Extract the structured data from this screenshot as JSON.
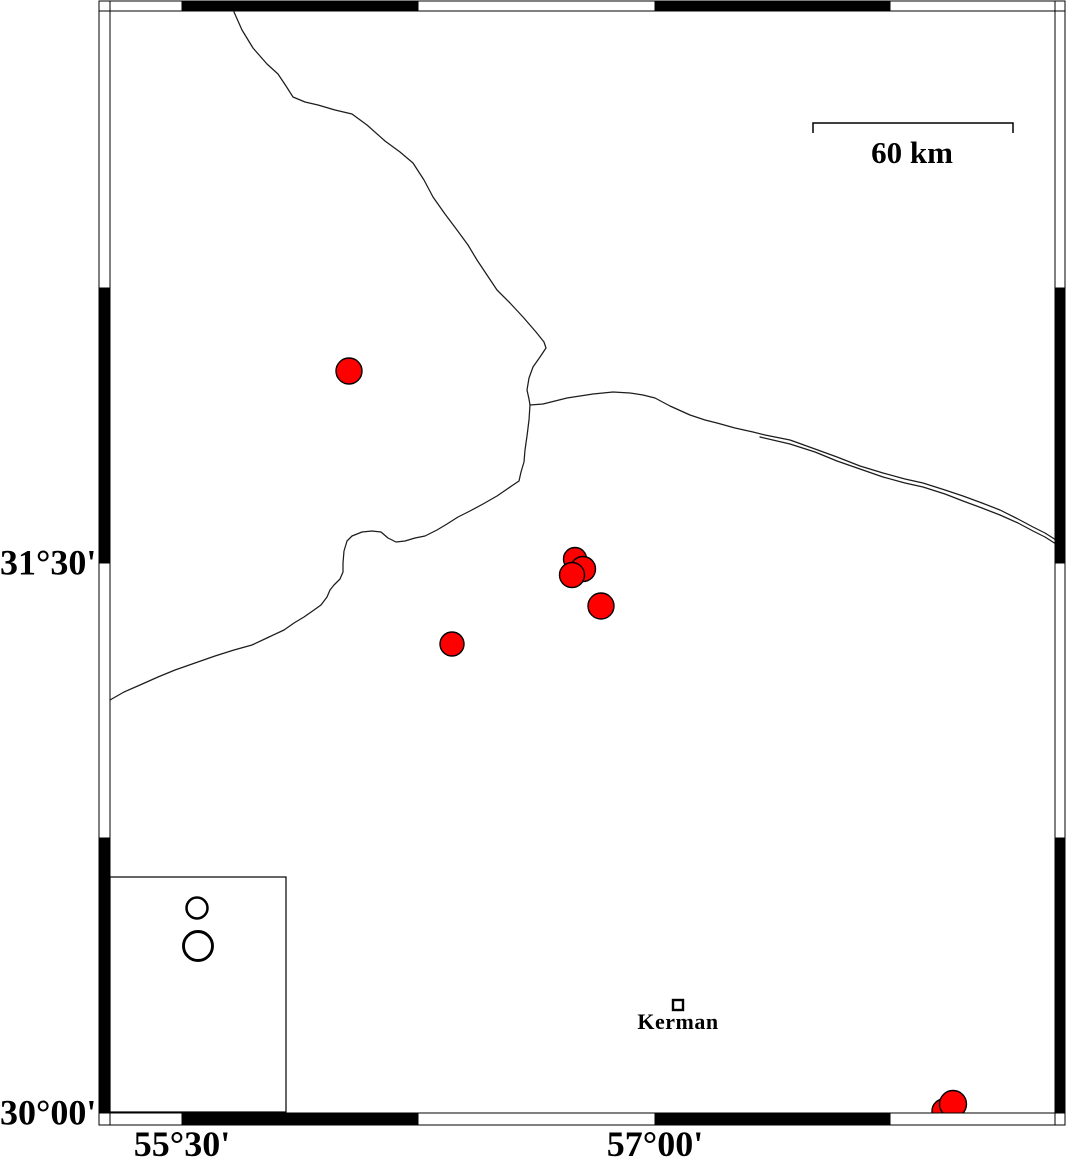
{
  "frame": {
    "outer": {
      "x": 99,
      "y": 1,
      "w": 966,
      "h": 1124
    },
    "inner": {
      "x": 110,
      "y": 11,
      "w": 945,
      "h": 1102
    },
    "x_bounds": [
      110,
      182,
      418,
      655,
      890,
      1055
    ],
    "x_fills": [
      "#ffffff",
      "#000000",
      "#ffffff",
      "#000000",
      "#ffffff"
    ],
    "y_bounds": [
      11,
      288,
      563,
      838,
      1113
    ],
    "y_fills": [
      "#ffffff",
      "#000000",
      "#ffffff",
      "#000000"
    ],
    "line_color": "#000000"
  },
  "axes": {
    "lat_labels": [
      {
        "text": "31°30'",
        "y": 563
      },
      {
        "text": "30°00'",
        "y": 1113
      }
    ],
    "lon_labels": [
      {
        "text": "55°30'",
        "x": 182
      },
      {
        "text": "57°00'",
        "x": 655
      }
    ]
  },
  "scale_bar": {
    "label": "60 km",
    "x1": 813,
    "x2": 1013,
    "y": 123,
    "tick_len": 10,
    "label_pos": {
      "x": 912,
      "y": 137
    }
  },
  "city": {
    "label": "Kerman",
    "x": 678,
    "y": 1005,
    "size": 10,
    "label_pos": {
      "x": 678,
      "y": 1011
    }
  },
  "legend": {
    "box": {
      "x": 110,
      "y": 877,
      "w": 176,
      "h": 235
    },
    "symbols": [
      {
        "x": 197,
        "y": 908,
        "r": 10.5,
        "stroke_w": 2.5
      },
      {
        "x": 198,
        "y": 946,
        "r": 14.5,
        "stroke_w": 2.9
      }
    ]
  },
  "epicenters": {
    "fill": "#ff0000",
    "stroke": "#000000",
    "stroke_w": 1.4,
    "points": [
      {
        "x": 349,
        "y": 371,
        "r": 13
      },
      {
        "x": 944,
        "y": 1111,
        "r": 12
      },
      {
        "x": 953,
        "y": 1104,
        "r": 13.5
      },
      {
        "x": 575,
        "y": 559,
        "r": 11.5
      },
      {
        "x": 583,
        "y": 569,
        "r": 12.5
      },
      {
        "x": 572,
        "y": 575,
        "r": 12.5
      },
      {
        "x": 601,
        "y": 606,
        "r": 13
      },
      {
        "x": 452,
        "y": 644,
        "r": 12
      }
    ]
  },
  "boundaries": {
    "stroke": "#1c1c1c",
    "width": 1.25,
    "paths": [
      [
        [
          234,
          12
        ],
        [
          242,
          30
        ],
        [
          253,
          48
        ],
        [
          267,
          64
        ],
        [
          278,
          74
        ],
        [
          286,
          86
        ],
        [
          293,
          97
        ],
        [
          305,
          102
        ],
        [
          318,
          105
        ],
        [
          335,
          110
        ],
        [
          352,
          114
        ],
        [
          367,
          125
        ],
        [
          385,
          141
        ],
        [
          400,
          152
        ],
        [
          413,
          163
        ],
        [
          424,
          180
        ],
        [
          433,
          197
        ],
        [
          445,
          214
        ],
        [
          457,
          230
        ],
        [
          468,
          245
        ],
        [
          477,
          260
        ],
        [
          487,
          275
        ],
        [
          497,
          290
        ],
        [
          510,
          303
        ],
        [
          523,
          317
        ],
        [
          536,
          332
        ],
        [
          544,
          342
        ],
        [
          546,
          348
        ],
        [
          540,
          357
        ],
        [
          533,
          367
        ],
        [
          529,
          378
        ],
        [
          527,
          390
        ],
        [
          529,
          399
        ],
        [
          530,
          405
        ]
      ],
      [
        [
          530,
          405
        ],
        [
          543,
          404
        ],
        [
          567,
          398
        ],
        [
          593,
          394
        ],
        [
          613,
          392
        ],
        [
          630,
          393
        ],
        [
          643,
          395
        ],
        [
          655,
          398
        ],
        [
          670,
          406
        ],
        [
          690,
          415
        ],
        [
          705,
          420
        ],
        [
          717,
          423
        ],
        [
          735,
          428
        ],
        [
          753,
          432
        ],
        [
          765,
          435
        ],
        [
          790,
          440
        ],
        [
          815,
          449
        ],
        [
          837,
          457
        ],
        [
          860,
          466
        ],
        [
          883,
          473
        ],
        [
          905,
          479
        ],
        [
          923,
          483
        ],
        [
          945,
          490
        ],
        [
          963,
          496
        ],
        [
          982,
          503
        ],
        [
          1000,
          510
        ],
        [
          1018,
          519
        ],
        [
          1033,
          527
        ],
        [
          1045,
          533
        ],
        [
          1056,
          540
        ]
      ],
      [
        [
          760,
          437
        ],
        [
          790,
          444
        ],
        [
          815,
          452
        ],
        [
          837,
          461
        ],
        [
          860,
          469
        ],
        [
          883,
          477
        ],
        [
          905,
          483
        ],
        [
          923,
          487
        ],
        [
          945,
          494
        ],
        [
          963,
          501
        ],
        [
          982,
          508
        ],
        [
          1000,
          515
        ],
        [
          1018,
          523
        ],
        [
          1033,
          531
        ],
        [
          1045,
          537
        ],
        [
          1056,
          544
        ]
      ],
      [
        [
          530,
          405
        ],
        [
          529,
          420
        ],
        [
          527,
          436
        ],
        [
          525,
          450
        ],
        [
          524,
          462
        ],
        [
          521,
          472
        ],
        [
          519,
          481
        ],
        [
          513,
          485
        ],
        [
          497,
          496
        ],
        [
          483,
          504
        ],
        [
          470,
          511
        ],
        [
          458,
          517
        ],
        [
          447,
          524
        ],
        [
          437,
          530
        ],
        [
          425,
          536
        ],
        [
          415,
          538
        ],
        [
          405,
          541
        ],
        [
          396,
          542
        ],
        [
          388,
          538
        ],
        [
          381,
          532
        ],
        [
          372,
          531
        ],
        [
          362,
          532
        ],
        [
          352,
          536
        ],
        [
          347,
          541
        ],
        [
          344,
          551
        ],
        [
          343,
          563
        ],
        [
          343,
          572
        ],
        [
          340,
          579
        ],
        [
          334,
          585
        ],
        [
          330,
          590
        ],
        [
          327,
          597
        ],
        [
          321,
          605
        ],
        [
          314,
          610
        ],
        [
          304,
          617
        ],
        [
          294,
          623
        ],
        [
          284,
          630
        ],
        [
          269,
          637
        ],
        [
          252,
          645
        ],
        [
          234,
          650
        ],
        [
          215,
          656
        ],
        [
          195,
          663
        ],
        [
          175,
          670
        ],
        [
          158,
          677
        ],
        [
          140,
          685
        ],
        [
          124,
          692
        ],
        [
          110,
          700
        ]
      ]
    ]
  }
}
